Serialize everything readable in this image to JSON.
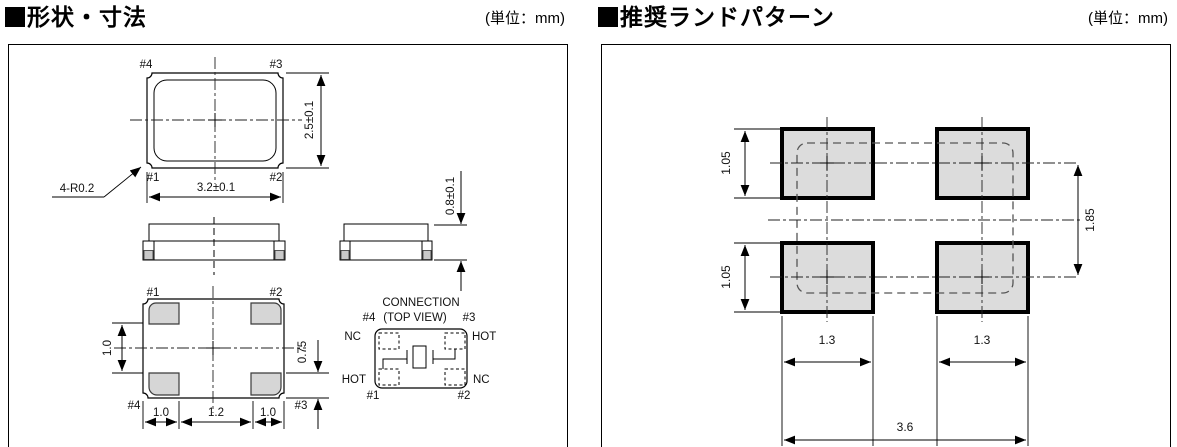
{
  "left_panel": {
    "marker": "■",
    "title": "形状・寸法",
    "unit": "(単位：mm)",
    "top_view": {
      "pin_top_left": "#4",
      "pin_top_right": "#3",
      "pin_bottom_left": "#1",
      "pin_bottom_right": "#2",
      "dim_height": "2.5±0.1",
      "dim_width": "3.2±0.1",
      "corner_note": "4-R0.2"
    },
    "side_view": {
      "dim_height": "0.8±0.1"
    },
    "bottom_view": {
      "pin_top_left": "#1",
      "pin_top_right": "#2",
      "pin_bottom_left": "#4",
      "pin_bottom_right": "#3",
      "dim_pad_gap": "1.0",
      "dim_pad_height": "0.75",
      "dim_bottom_left": "1.0",
      "dim_bottom_center": "1.2",
      "dim_bottom_right": "1.0"
    },
    "connection": {
      "title": "CONNECTION",
      "subtitle": "(TOP VIEW)",
      "pin_top_left": "#4",
      "pin_top_right": "#3",
      "pin_bottom_left": "#1",
      "pin_bottom_right": "#2",
      "net_top_left": "NC",
      "net_top_right": "HOT",
      "net_bottom_left": "HOT",
      "net_bottom_right": "NC"
    }
  },
  "right_panel": {
    "marker": "■",
    "title": "推奨ランドパターン",
    "unit": "(単位：mm)",
    "land_pattern": {
      "dim_pad_height_top": "1.05",
      "dim_pad_height_bottom": "1.05",
      "dim_row_pitch": "1.85",
      "dim_pad_width_left": "1.3",
      "dim_pad_width_right": "1.3",
      "dim_overall_width": "3.6"
    }
  },
  "colors": {
    "line": "#000000",
    "pad_fill": "#dcdcdc",
    "outline_dash": "#555555",
    "background": "#ffffff"
  }
}
